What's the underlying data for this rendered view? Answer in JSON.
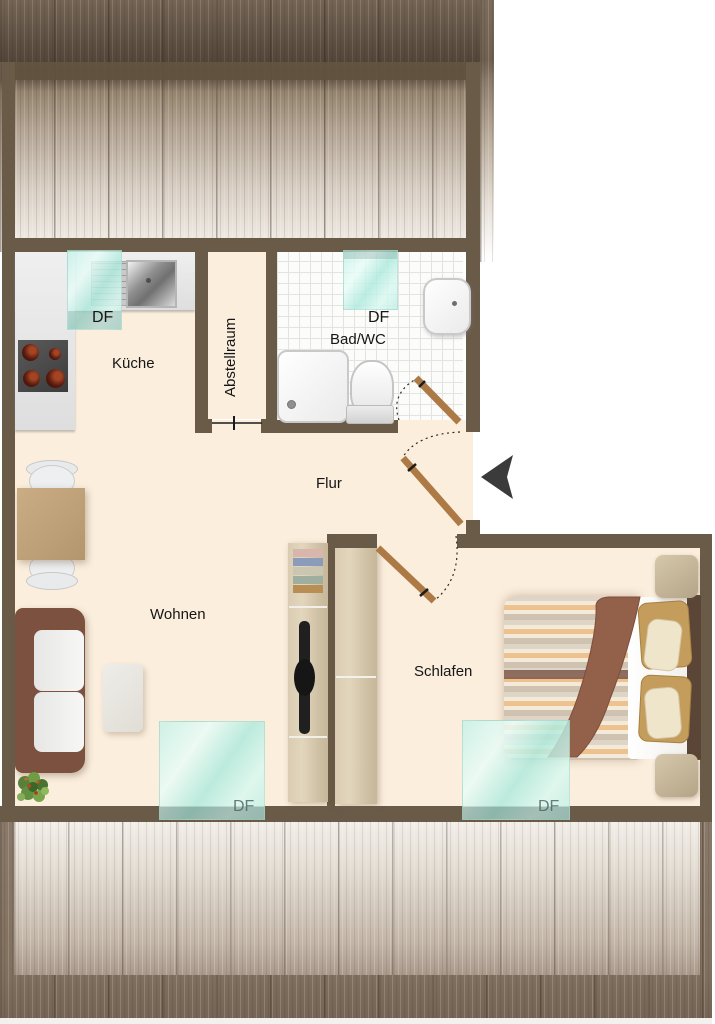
{
  "rooms": {
    "kitchen": "Küche",
    "storage": "Abstellraum",
    "bathroom": "Bad/WC",
    "hallway": "Flur",
    "living": "Wohnen",
    "bedroom": "Schlafen"
  },
  "skylights": {
    "kitchen": "DF",
    "bathroom": "DF",
    "living": "DF",
    "bedroom": "DF"
  },
  "colors": {
    "wall": "#6a5b49",
    "floor": "#fbeedd",
    "tile": "#fcfcfb",
    "skylight_glass": "#bfefe5",
    "roof_dark": "#6f6050",
    "roof_light": "#efeae3",
    "door_wood": "#ad7a45",
    "entrance_arrow": "#3b3b3b",
    "sofa_frame": "#7c5140",
    "bed_throw": "#93604a",
    "table_wood": "#c2a47c"
  }
}
